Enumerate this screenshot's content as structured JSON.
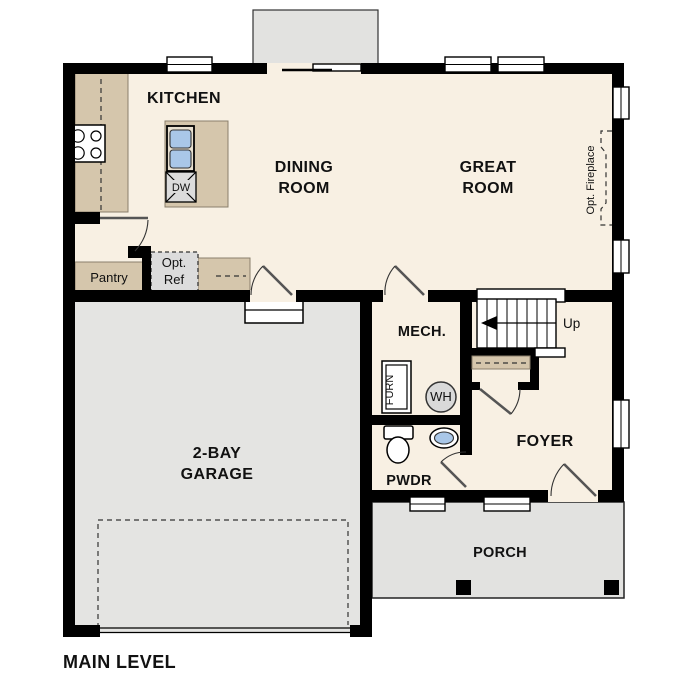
{
  "title": "MAIN LEVEL",
  "colors": {
    "wall": "#000000",
    "floor": "#f8f0e3",
    "garage_floor": "#e4e4e2",
    "porch_floor": "#e2e2e0",
    "counter_tan": "#d5c6ac",
    "fixture_blue": "#a9c7e8",
    "ref_gray": "#dcdcdc",
    "wh_gray": "#d9d9d9"
  },
  "rooms": {
    "kitchen": {
      "label": "KITCHEN"
    },
    "dining": {
      "lines": [
        "DINING",
        "ROOM"
      ]
    },
    "great": {
      "lines": [
        "GREAT",
        "ROOM"
      ]
    },
    "garage": {
      "lines": [
        "2-BAY",
        "GARAGE"
      ]
    },
    "mech": {
      "label": "MECH."
    },
    "foyer": {
      "label": "FOYER"
    },
    "pwdr": {
      "label": "PWDR"
    },
    "porch": {
      "label": "PORCH"
    },
    "pantry": {
      "label": "Pantry"
    }
  },
  "fixtures": {
    "opt_ref": {
      "lines": [
        "Opt.",
        "Ref"
      ]
    },
    "opt_fireplace": {
      "label": "Opt. Fireplace"
    },
    "stairs": {
      "direction_label": "Up"
    },
    "dishwasher": {
      "label": "DW"
    },
    "furnace": {
      "label": "FURN"
    },
    "water_heater": {
      "label": "WH"
    }
  }
}
